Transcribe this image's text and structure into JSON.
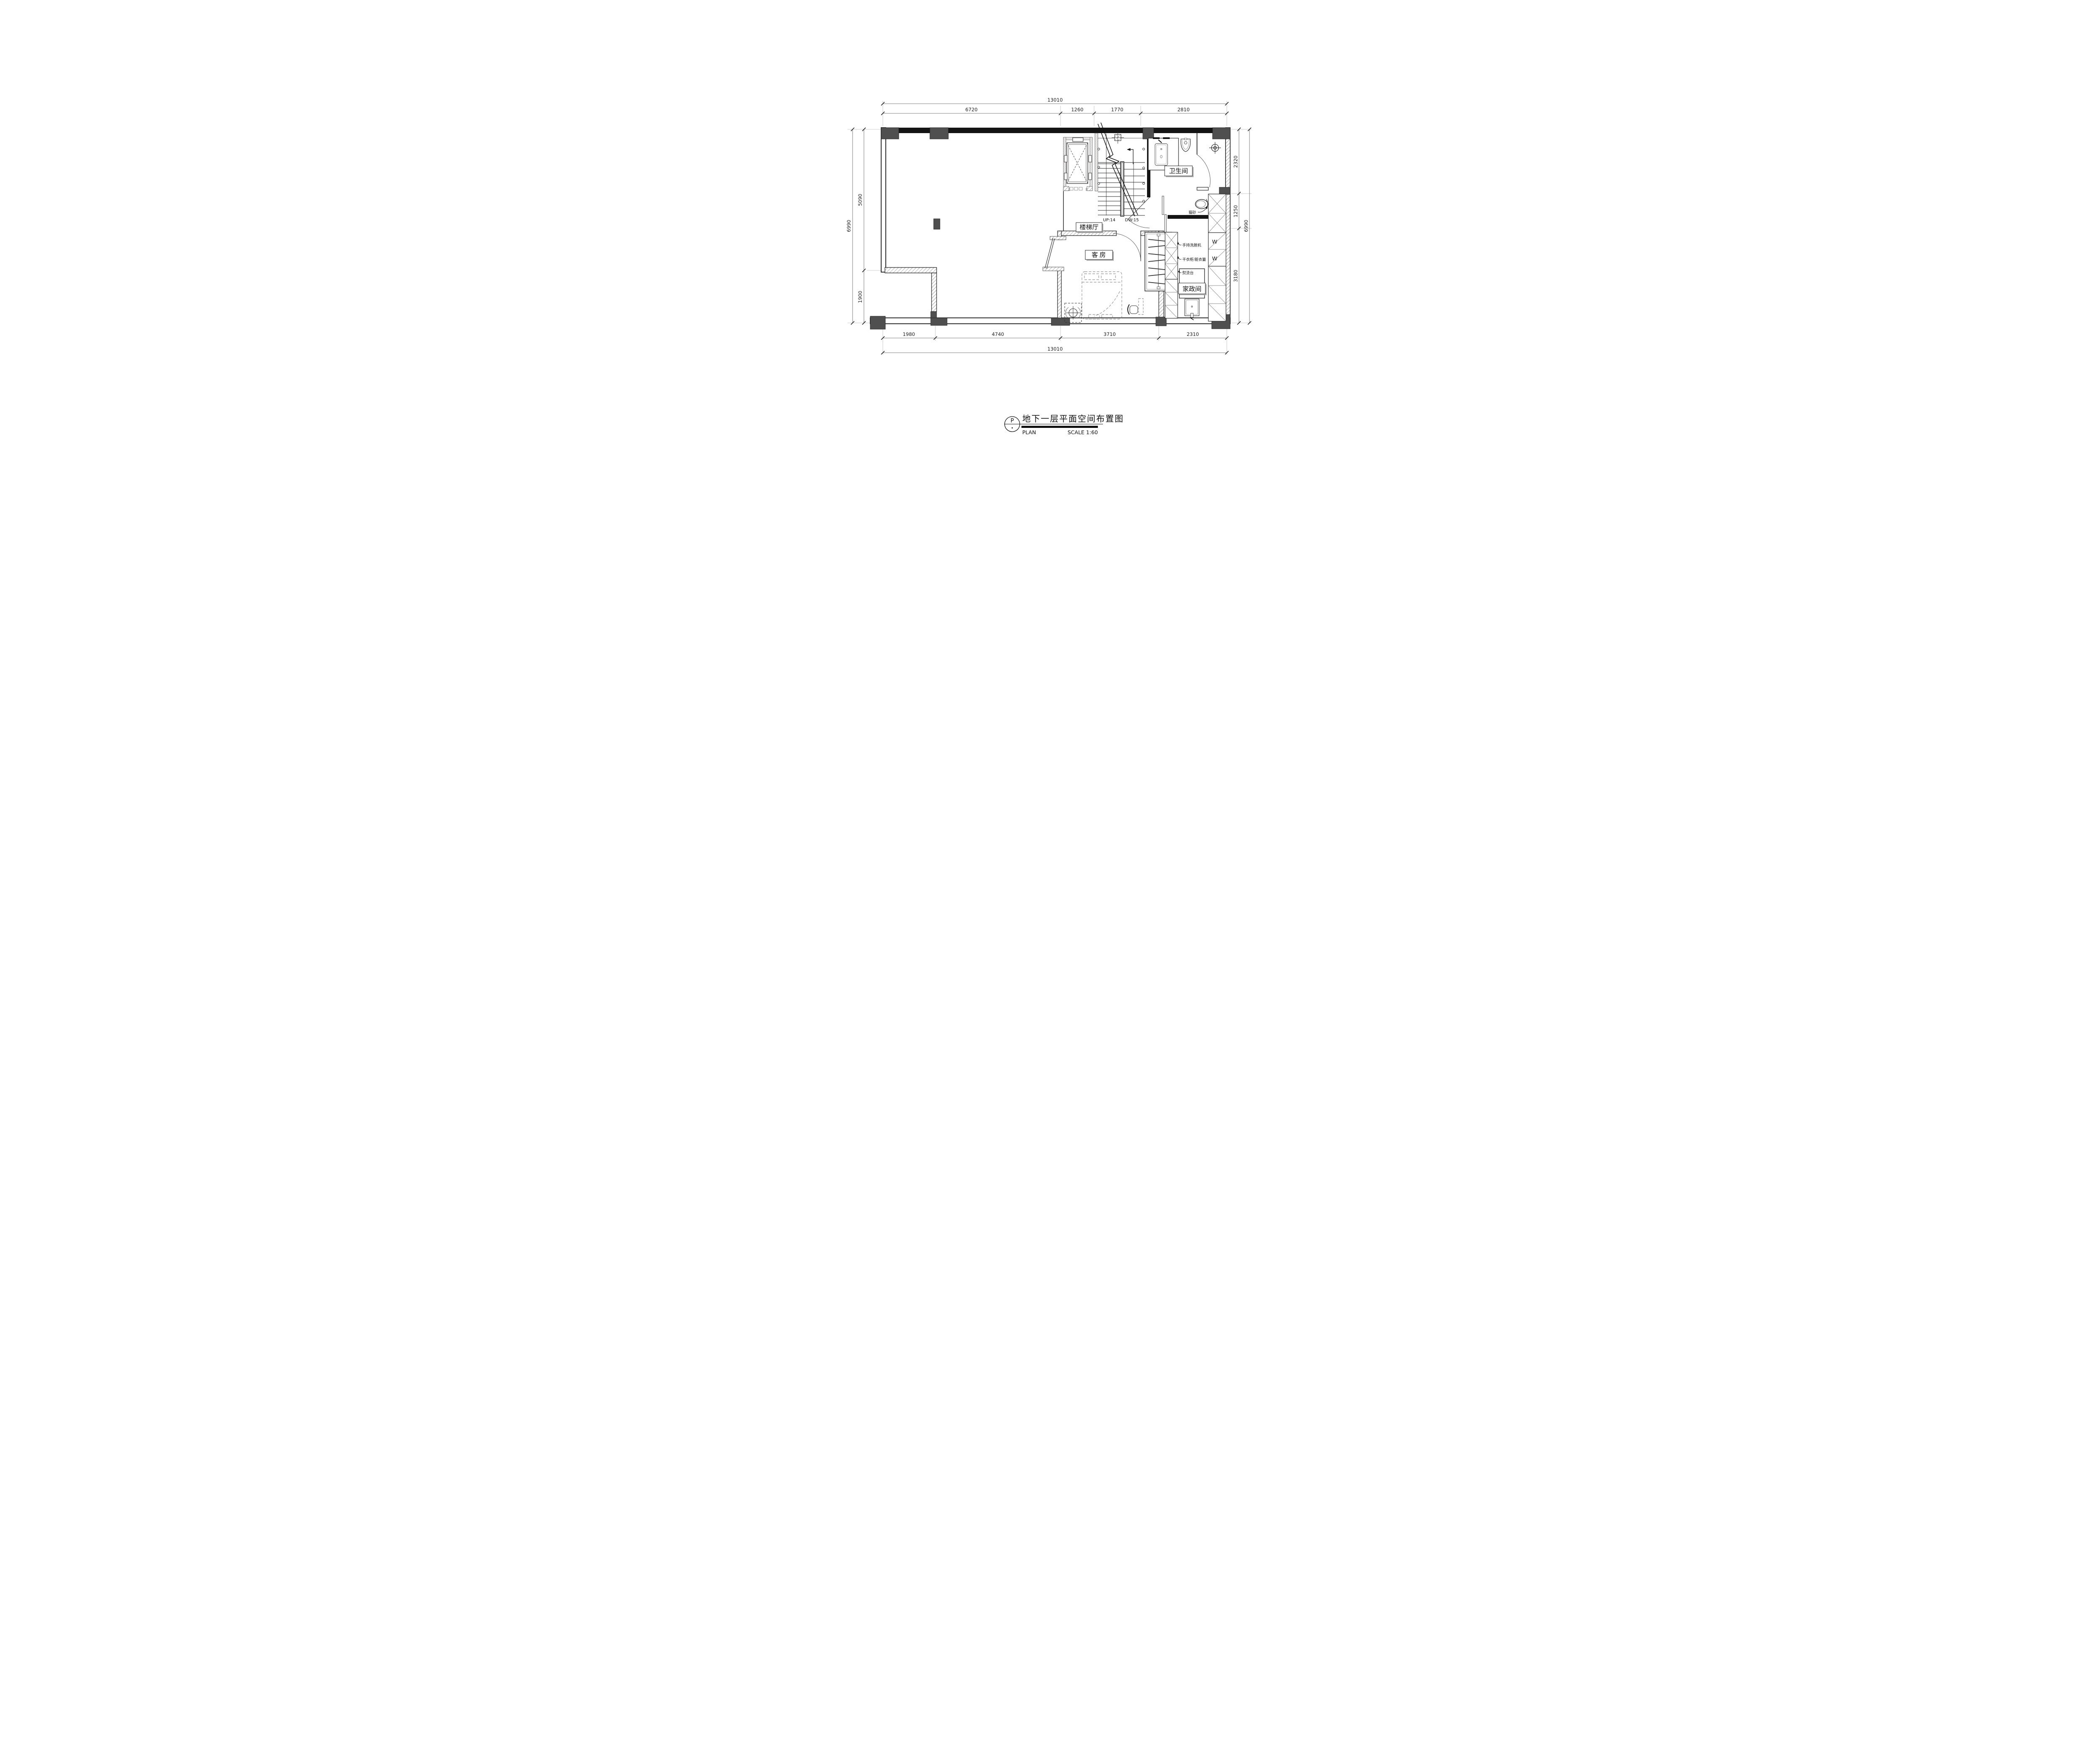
{
  "title_block": {
    "marker": "P",
    "title": "地下一层平面空间布置图",
    "plan_label": "PLAN",
    "scale_label": "SCALE 1:60"
  },
  "rooms": {
    "stair_hall": "楼梯厅",
    "bathroom": "卫生间",
    "guest_room": "客 房",
    "laundry": "家政间"
  },
  "stairs": {
    "up": "UP:14",
    "down": "DW:15"
  },
  "annotations": {
    "cat_litter": "猫砂",
    "handheld_washer": "手持洗脱机",
    "drying_cabinet": "干衣柜/脏衣篓",
    "ironing_board": "熨烫台",
    "washer_top": "W",
    "washer_bottom": "W"
  },
  "dimensions": {
    "top": {
      "overall": "13010",
      "segments": [
        "6720",
        "1260",
        "1770",
        "2810"
      ]
    },
    "bottom": {
      "overall": "13010",
      "segments": [
        "1980",
        "4740",
        "3710",
        "2310"
      ]
    },
    "left": {
      "overall": "6990",
      "segments": [
        "5090",
        "1900"
      ]
    },
    "right": {
      "overall": "6990",
      "segments": [
        "2320",
        "1250",
        "3180"
      ]
    }
  },
  "colors": {
    "wall": "#141414",
    "column": "#4f4f4f",
    "dim_text": "#1f1f1f",
    "label_shadow": "#b5b5b5"
  }
}
